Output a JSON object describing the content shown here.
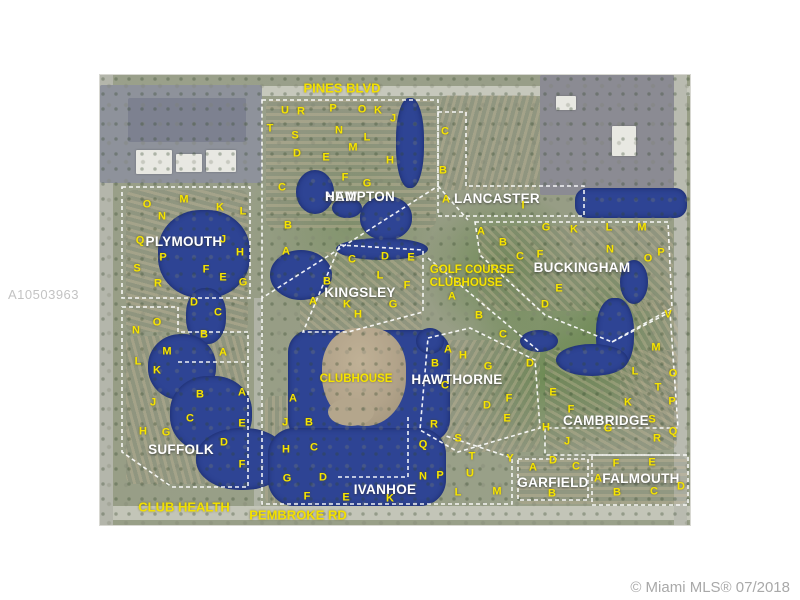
{
  "page": {
    "background": "#ffffff"
  },
  "watermark": {
    "text": "A10503963"
  },
  "credit": {
    "text": "© Miami MLS® 07/2018"
  },
  "map": {
    "colors": {
      "lake": "#2e4494",
      "letters": "#f6e400",
      "boundaries": "#ffffff",
      "neighborhood_labels": "#ffffff",
      "road_labels": "#f2e000"
    },
    "road_labels": [
      {
        "name": "PINES BLVD",
        "x": 342,
        "y": 88
      },
      {
        "name": "PEMBROKE RD",
        "x": 298,
        "y": 515
      },
      {
        "name": "CLUB HEALTH",
        "x": 184,
        "y": 507
      }
    ],
    "neighborhoods": [
      {
        "name": "NEW HAMPTON",
        "x": 325,
        "y": 190,
        "stacked": true
      },
      {
        "name": "PLYMOUTH",
        "x": 184,
        "y": 242
      },
      {
        "name": "LANCASTER",
        "x": 497,
        "y": 199
      },
      {
        "name": "BUCKINGHAM",
        "x": 582,
        "y": 268
      },
      {
        "name": "KINGSLEY",
        "x": 360,
        "y": 293
      },
      {
        "name": "HAWTHORNE",
        "x": 457,
        "y": 380
      },
      {
        "name": "SUFFOLK",
        "x": 181,
        "y": 450
      },
      {
        "name": "CAMBRIDGE",
        "x": 606,
        "y": 421
      },
      {
        "name": "IVANHOE",
        "x": 385,
        "y": 490
      },
      {
        "name": "GARFIELD",
        "x": 553,
        "y": 483
      },
      {
        "name": "FALMOUTH",
        "x": 641,
        "y": 479
      }
    ],
    "facility_labels": [
      {
        "name": "GOLF COURSE",
        "x": 472,
        "y": 270
      },
      {
        "name": "CLUBHOUSE",
        "x": 466,
        "y": 283
      },
      {
        "name": "CLUBHOUSE",
        "x": 356,
        "y": 379
      }
    ],
    "letters": [
      {
        "t": "U",
        "x": 285,
        "y": 111
      },
      {
        "t": "R",
        "x": 301,
        "y": 112
      },
      {
        "t": "P",
        "x": 333,
        "y": 109
      },
      {
        "t": "O",
        "x": 362,
        "y": 110
      },
      {
        "t": "K",
        "x": 378,
        "y": 111
      },
      {
        "t": "J",
        "x": 393,
        "y": 119
      },
      {
        "t": "T",
        "x": 270,
        "y": 129
      },
      {
        "t": "S",
        "x": 295,
        "y": 136
      },
      {
        "t": "N",
        "x": 339,
        "y": 131
      },
      {
        "t": "L",
        "x": 367,
        "y": 138
      },
      {
        "t": "M",
        "x": 353,
        "y": 148
      },
      {
        "t": "D",
        "x": 297,
        "y": 154
      },
      {
        "t": "E",
        "x": 326,
        "y": 158
      },
      {
        "t": "H",
        "x": 390,
        "y": 161
      },
      {
        "t": "F",
        "x": 345,
        "y": 178
      },
      {
        "t": "G",
        "x": 367,
        "y": 184
      },
      {
        "t": "C",
        "x": 282,
        "y": 188
      },
      {
        "t": "B",
        "x": 288,
        "y": 226
      },
      {
        "t": "A",
        "x": 286,
        "y": 252
      },
      {
        "t": "C",
        "x": 445,
        "y": 132
      },
      {
        "t": "B",
        "x": 443,
        "y": 171
      },
      {
        "t": "A",
        "x": 446,
        "y": 200
      },
      {
        "t": "I",
        "x": 523,
        "y": 206
      },
      {
        "t": "O",
        "x": 147,
        "y": 205
      },
      {
        "t": "M",
        "x": 184,
        "y": 200
      },
      {
        "t": "K",
        "x": 220,
        "y": 208
      },
      {
        "t": "L",
        "x": 243,
        "y": 212
      },
      {
        "t": "N",
        "x": 162,
        "y": 217
      },
      {
        "t": "Q",
        "x": 140,
        "y": 241
      },
      {
        "t": "J",
        "x": 223,
        "y": 240
      },
      {
        "t": "H",
        "x": 240,
        "y": 253
      },
      {
        "t": "P",
        "x": 163,
        "y": 258
      },
      {
        "t": "S",
        "x": 137,
        "y": 269
      },
      {
        "t": "F",
        "x": 206,
        "y": 270
      },
      {
        "t": "E",
        "x": 223,
        "y": 278
      },
      {
        "t": "R",
        "x": 158,
        "y": 284
      },
      {
        "t": "G",
        "x": 243,
        "y": 283
      },
      {
        "t": "D",
        "x": 194,
        "y": 303
      },
      {
        "t": "C",
        "x": 218,
        "y": 313
      },
      {
        "t": "B",
        "x": 204,
        "y": 335
      },
      {
        "t": "O",
        "x": 157,
        "y": 323
      },
      {
        "t": "N",
        "x": 136,
        "y": 331
      },
      {
        "t": "M",
        "x": 167,
        "y": 352
      },
      {
        "t": "A",
        "x": 223,
        "y": 353
      },
      {
        "t": "L",
        "x": 138,
        "y": 362
      },
      {
        "t": "K",
        "x": 157,
        "y": 371
      },
      {
        "t": "B",
        "x": 200,
        "y": 395
      },
      {
        "t": "A",
        "x": 242,
        "y": 393
      },
      {
        "t": "J",
        "x": 153,
        "y": 403
      },
      {
        "t": "C",
        "x": 190,
        "y": 419
      },
      {
        "t": "E",
        "x": 242,
        "y": 424
      },
      {
        "t": "H",
        "x": 143,
        "y": 432
      },
      {
        "t": "G",
        "x": 166,
        "y": 433
      },
      {
        "t": "D",
        "x": 224,
        "y": 443
      },
      {
        "t": "F",
        "x": 242,
        "y": 465
      },
      {
        "t": "C",
        "x": 352,
        "y": 260
      },
      {
        "t": "D",
        "x": 385,
        "y": 257
      },
      {
        "t": "E",
        "x": 411,
        "y": 258
      },
      {
        "t": "L",
        "x": 380,
        "y": 276
      },
      {
        "t": "B",
        "x": 327,
        "y": 282
      },
      {
        "t": "F",
        "x": 407,
        "y": 286
      },
      {
        "t": "A",
        "x": 313,
        "y": 302
      },
      {
        "t": "K",
        "x": 347,
        "y": 305
      },
      {
        "t": "G",
        "x": 393,
        "y": 305
      },
      {
        "t": "H",
        "x": 358,
        "y": 315
      },
      {
        "t": "A",
        "x": 481,
        "y": 232
      },
      {
        "t": "G",
        "x": 546,
        "y": 228
      },
      {
        "t": "K",
        "x": 574,
        "y": 230
      },
      {
        "t": "A",
        "x": 452,
        "y": 297
      },
      {
        "t": "B",
        "x": 479,
        "y": 316
      },
      {
        "t": "C",
        "x": 503,
        "y": 335
      },
      {
        "t": "B",
        "x": 503,
        "y": 243
      },
      {
        "t": "C",
        "x": 520,
        "y": 257
      },
      {
        "t": "F",
        "x": 540,
        "y": 255
      },
      {
        "t": "L",
        "x": 609,
        "y": 228
      },
      {
        "t": "M",
        "x": 642,
        "y": 228
      },
      {
        "t": "N",
        "x": 610,
        "y": 250
      },
      {
        "t": "O",
        "x": 648,
        "y": 259
      },
      {
        "t": "P",
        "x": 661,
        "y": 253
      },
      {
        "t": "E",
        "x": 559,
        "y": 289
      },
      {
        "t": "D",
        "x": 545,
        "y": 305
      },
      {
        "t": "V",
        "x": 668,
        "y": 315
      },
      {
        "t": "M",
        "x": 656,
        "y": 348
      },
      {
        "t": "L",
        "x": 635,
        "y": 372
      },
      {
        "t": "O",
        "x": 673,
        "y": 374
      },
      {
        "t": "T",
        "x": 658,
        "y": 388
      },
      {
        "t": "K",
        "x": 628,
        "y": 403
      },
      {
        "t": "P",
        "x": 672,
        "y": 402
      },
      {
        "t": "E",
        "x": 553,
        "y": 393
      },
      {
        "t": "F",
        "x": 571,
        "y": 410
      },
      {
        "t": "H",
        "x": 546,
        "y": 428
      },
      {
        "t": "G",
        "x": 608,
        "y": 429
      },
      {
        "t": "S",
        "x": 652,
        "y": 420
      },
      {
        "t": "Q",
        "x": 673,
        "y": 432
      },
      {
        "t": "J",
        "x": 567,
        "y": 442
      },
      {
        "t": "R",
        "x": 657,
        "y": 439
      },
      {
        "t": "A",
        "x": 448,
        "y": 350
      },
      {
        "t": "H",
        "x": 463,
        "y": 356
      },
      {
        "t": "B",
        "x": 435,
        "y": 364
      },
      {
        "t": "G",
        "x": 488,
        "y": 367
      },
      {
        "t": "D",
        "x": 530,
        "y": 364
      },
      {
        "t": "C",
        "x": 445,
        "y": 386
      },
      {
        "t": "F",
        "x": 509,
        "y": 399
      },
      {
        "t": "D",
        "x": 487,
        "y": 406
      },
      {
        "t": "E",
        "x": 507,
        "y": 419
      },
      {
        "t": "A",
        "x": 293,
        "y": 399
      },
      {
        "t": "J",
        "x": 285,
        "y": 423
      },
      {
        "t": "B",
        "x": 309,
        "y": 423
      },
      {
        "t": "H",
        "x": 286,
        "y": 450
      },
      {
        "t": "C",
        "x": 314,
        "y": 448
      },
      {
        "t": "G",
        "x": 287,
        "y": 479
      },
      {
        "t": "D",
        "x": 323,
        "y": 478
      },
      {
        "t": "F",
        "x": 307,
        "y": 497
      },
      {
        "t": "E",
        "x": 346,
        "y": 498
      },
      {
        "t": "K",
        "x": 390,
        "y": 499
      },
      {
        "t": "R",
        "x": 434,
        "y": 425
      },
      {
        "t": "Q",
        "x": 423,
        "y": 445
      },
      {
        "t": "S",
        "x": 458,
        "y": 439
      },
      {
        "t": "T",
        "x": 472,
        "y": 457
      },
      {
        "t": "U",
        "x": 470,
        "y": 474
      },
      {
        "t": "N",
        "x": 423,
        "y": 477
      },
      {
        "t": "P",
        "x": 440,
        "y": 476
      },
      {
        "t": "Y",
        "x": 510,
        "y": 459
      },
      {
        "t": "L",
        "x": 458,
        "y": 493
      },
      {
        "t": "M",
        "x": 497,
        "y": 492
      },
      {
        "t": "A",
        "x": 533,
        "y": 468
      },
      {
        "t": "D",
        "x": 553,
        "y": 461
      },
      {
        "t": "C",
        "x": 576,
        "y": 467
      },
      {
        "t": "B",
        "x": 552,
        "y": 494
      },
      {
        "t": "F",
        "x": 616,
        "y": 464
      },
      {
        "t": "E",
        "x": 652,
        "y": 463
      },
      {
        "t": "A",
        "x": 598,
        "y": 479
      },
      {
        "t": "B",
        "x": 617,
        "y": 493
      },
      {
        "t": "C",
        "x": 654,
        "y": 492
      },
      {
        "t": "D",
        "x": 681,
        "y": 487
      }
    ]
  }
}
